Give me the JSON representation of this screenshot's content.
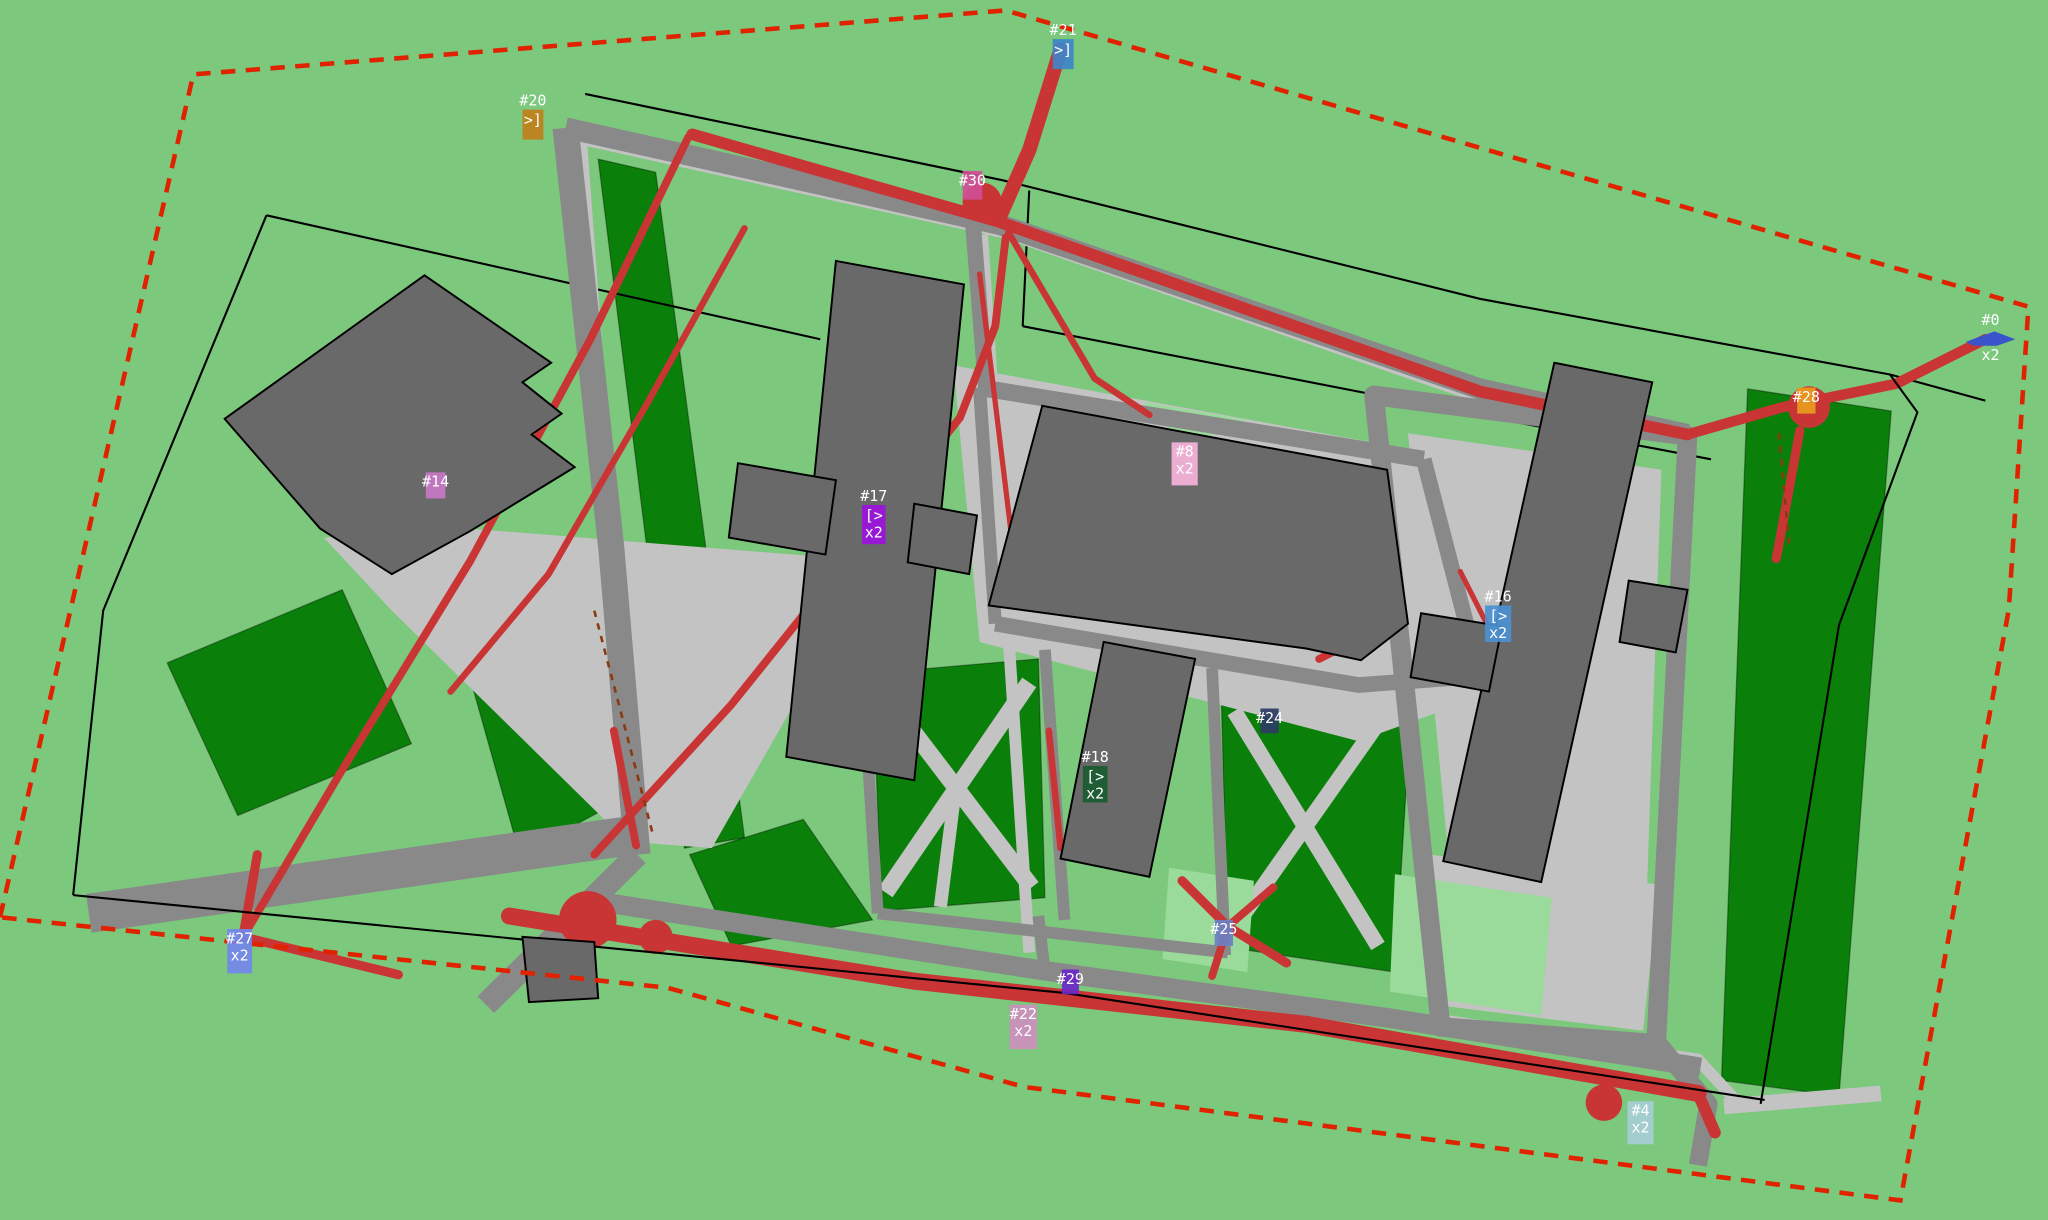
{
  "scene": {
    "description": "aerial site plan with buildings, lawns, roads, red agent trajectories and numbered annotation markers",
    "canvas": {
      "width": 2048,
      "height": 1220
    }
  },
  "palette": {
    "background_green": "#7cc87c",
    "lawn_dark_green": "#0a800a",
    "lawn_light_green": "#9ada9a",
    "road_gray": "#898989",
    "path_light_gray": "#c3c3c3",
    "building_gray": "#696969",
    "outline_black": "#000000",
    "trajectory_red": "#c93434",
    "boundary_dashed_red": "#e02200",
    "boundary_dashed_brown": "#8a3a10",
    "label_text": "#ffffff"
  },
  "markers": [
    {
      "id": "#20",
      "sub": [
        ">]"
      ],
      "color": "#c08019",
      "x": 400,
      "y": 84,
      "w": 16,
      "h": 23,
      "label_pos": "above"
    },
    {
      "id": "#21",
      "sub": [
        ">]"
      ],
      "color": "#3d85c8",
      "x": 806,
      "y": 30,
      "w": 16,
      "h": 23,
      "label_pos": "above"
    },
    {
      "id": "#30",
      "sub": [],
      "color": "#cf4f96",
      "x": 737,
      "y": 131,
      "w": 15,
      "h": 22,
      "label_pos": "inside"
    },
    {
      "id": "#14",
      "sub": [],
      "color": "#c878c8",
      "x": 326,
      "y": 362,
      "w": 15,
      "h": 20,
      "label_pos": "inside"
    },
    {
      "id": "#17",
      "sub": [
        "[>",
        "x2"
      ],
      "color": "#9b12dd",
      "x": 660,
      "y": 387,
      "w": 18,
      "h": 30,
      "label_pos": "above"
    },
    {
      "id": "#8",
      "sub": [
        "x2"
      ],
      "color": "#f6b3da",
      "x": 897,
      "y": 339,
      "w": 20,
      "h": 33,
      "label_pos": "inside"
    },
    {
      "id": "#16",
      "sub": [
        "[>",
        "x2"
      ],
      "color": "#4a90d2",
      "x": 1137,
      "y": 464,
      "w": 20,
      "h": 28,
      "label_pos": "above"
    },
    {
      "id": "#18",
      "sub": [
        "[>",
        "x2"
      ],
      "color": "#1a5c30",
      "x": 829,
      "y": 587,
      "w": 19,
      "h": 28,
      "label_pos": "above"
    },
    {
      "id": "#24",
      "sub": [],
      "color": "#2e3c64",
      "x": 965,
      "y": 543,
      "w": 14,
      "h": 19,
      "label_pos": "inside"
    },
    {
      "id": "#25",
      "sub": [],
      "color": "#6b80c4",
      "x": 930,
      "y": 705,
      "w": 14,
      "h": 20,
      "label_pos": "inside"
    },
    {
      "id": "#27",
      "sub": [
        "x2"
      ],
      "color": "#7287ea",
      "x": 174,
      "y": 712,
      "w": 19,
      "h": 34,
      "label_pos": "inside"
    },
    {
      "id": "#29",
      "sub": [],
      "color": "#6a28c8",
      "x": 813,
      "y": 743,
      "w": 13,
      "h": 19,
      "label_pos": "inside"
    },
    {
      "id": "#22",
      "sub": [
        "x2"
      ],
      "color": "#cc8fbe",
      "x": 773,
      "y": 770,
      "w": 21,
      "h": 34,
      "label_pos": "inside"
    },
    {
      "id": "#4",
      "sub": [
        "x2"
      ],
      "color": "#a7cdd6",
      "x": 1246,
      "y": 844,
      "w": 20,
      "h": 33,
      "label_pos": "inside"
    },
    {
      "id": "#28",
      "sub": [],
      "color": "#e89b1e",
      "x": 1376,
      "y": 297,
      "w": 14,
      "h": 20,
      "label_pos": "inside"
    },
    {
      "id": "#0",
      "sub": [
        "x2"
      ],
      "color": "#3a55cc",
      "x": 1505,
      "y": 252,
      "w": 38,
      "h": 14,
      "label_pos": "above",
      "shape": "arrow"
    }
  ]
}
